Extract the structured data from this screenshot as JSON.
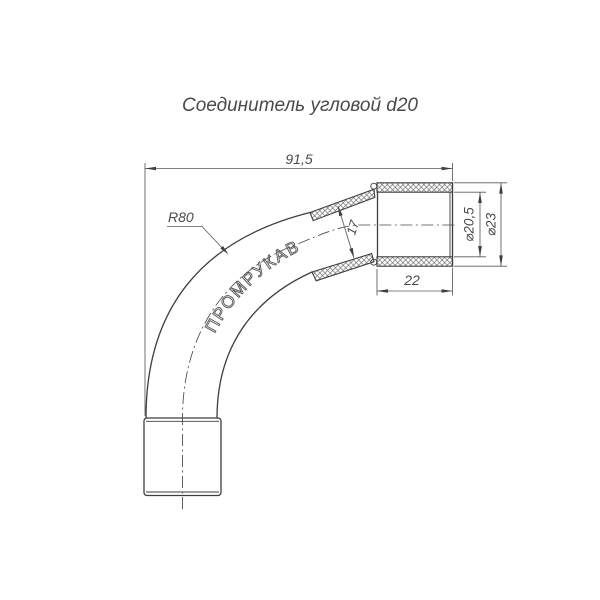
{
  "title": "Соединитель угловой d20",
  "brand_label": "ПРОМРУКАВ",
  "dimensions": {
    "overall_length": "91,5",
    "bend_radius": "R80",
    "tube_inner_diameter": "17",
    "socket_inner_diameter": "⌀20,5",
    "socket_outer_diameter": "⌀23",
    "socket_length": "22"
  },
  "colors": {
    "part_line": "#3e3e3e",
    "dimension_line": "#5a5a5a",
    "text": "#4a4a4a",
    "background": "#ffffff"
  }
}
